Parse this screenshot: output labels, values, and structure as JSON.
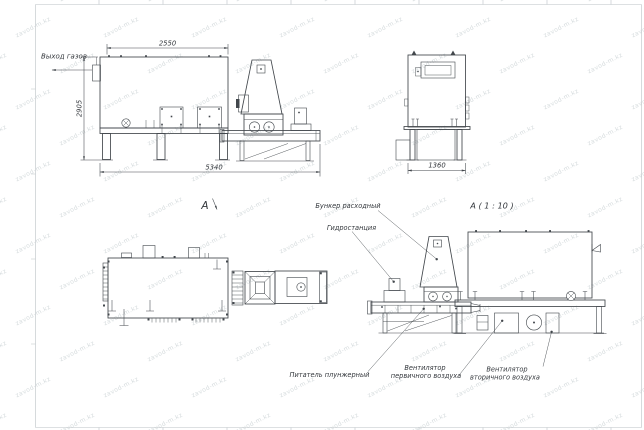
{
  "watermark": {
    "text": "zavod-m.kz"
  },
  "colors": {
    "line": "#42474c",
    "text": "#33373c",
    "frame": "#bcc2c6",
    "wm": "rgba(145,160,165,0.38)"
  },
  "views": {
    "side": {
      "gas_outlet_label": "Выход газов",
      "dim_top": "2550",
      "dim_left": "2905",
      "dim_bottom": "5340",
      "view_arrow_label": "A"
    },
    "end": {
      "dim_bottom": "1360"
    },
    "detail": {
      "title": "A ( 1 : 10 )",
      "callouts": {
        "hopper": "Бункер расходный",
        "hydraulic": "Гидростанция",
        "feeder": "Питатель плунжерный",
        "fan_primary_l1": "Вентилятор",
        "fan_primary_l2": "первичного воздуха",
        "fan_secondary_l1": "Вентилятор",
        "fan_secondary_l2": "вторичного воздуха"
      }
    }
  }
}
